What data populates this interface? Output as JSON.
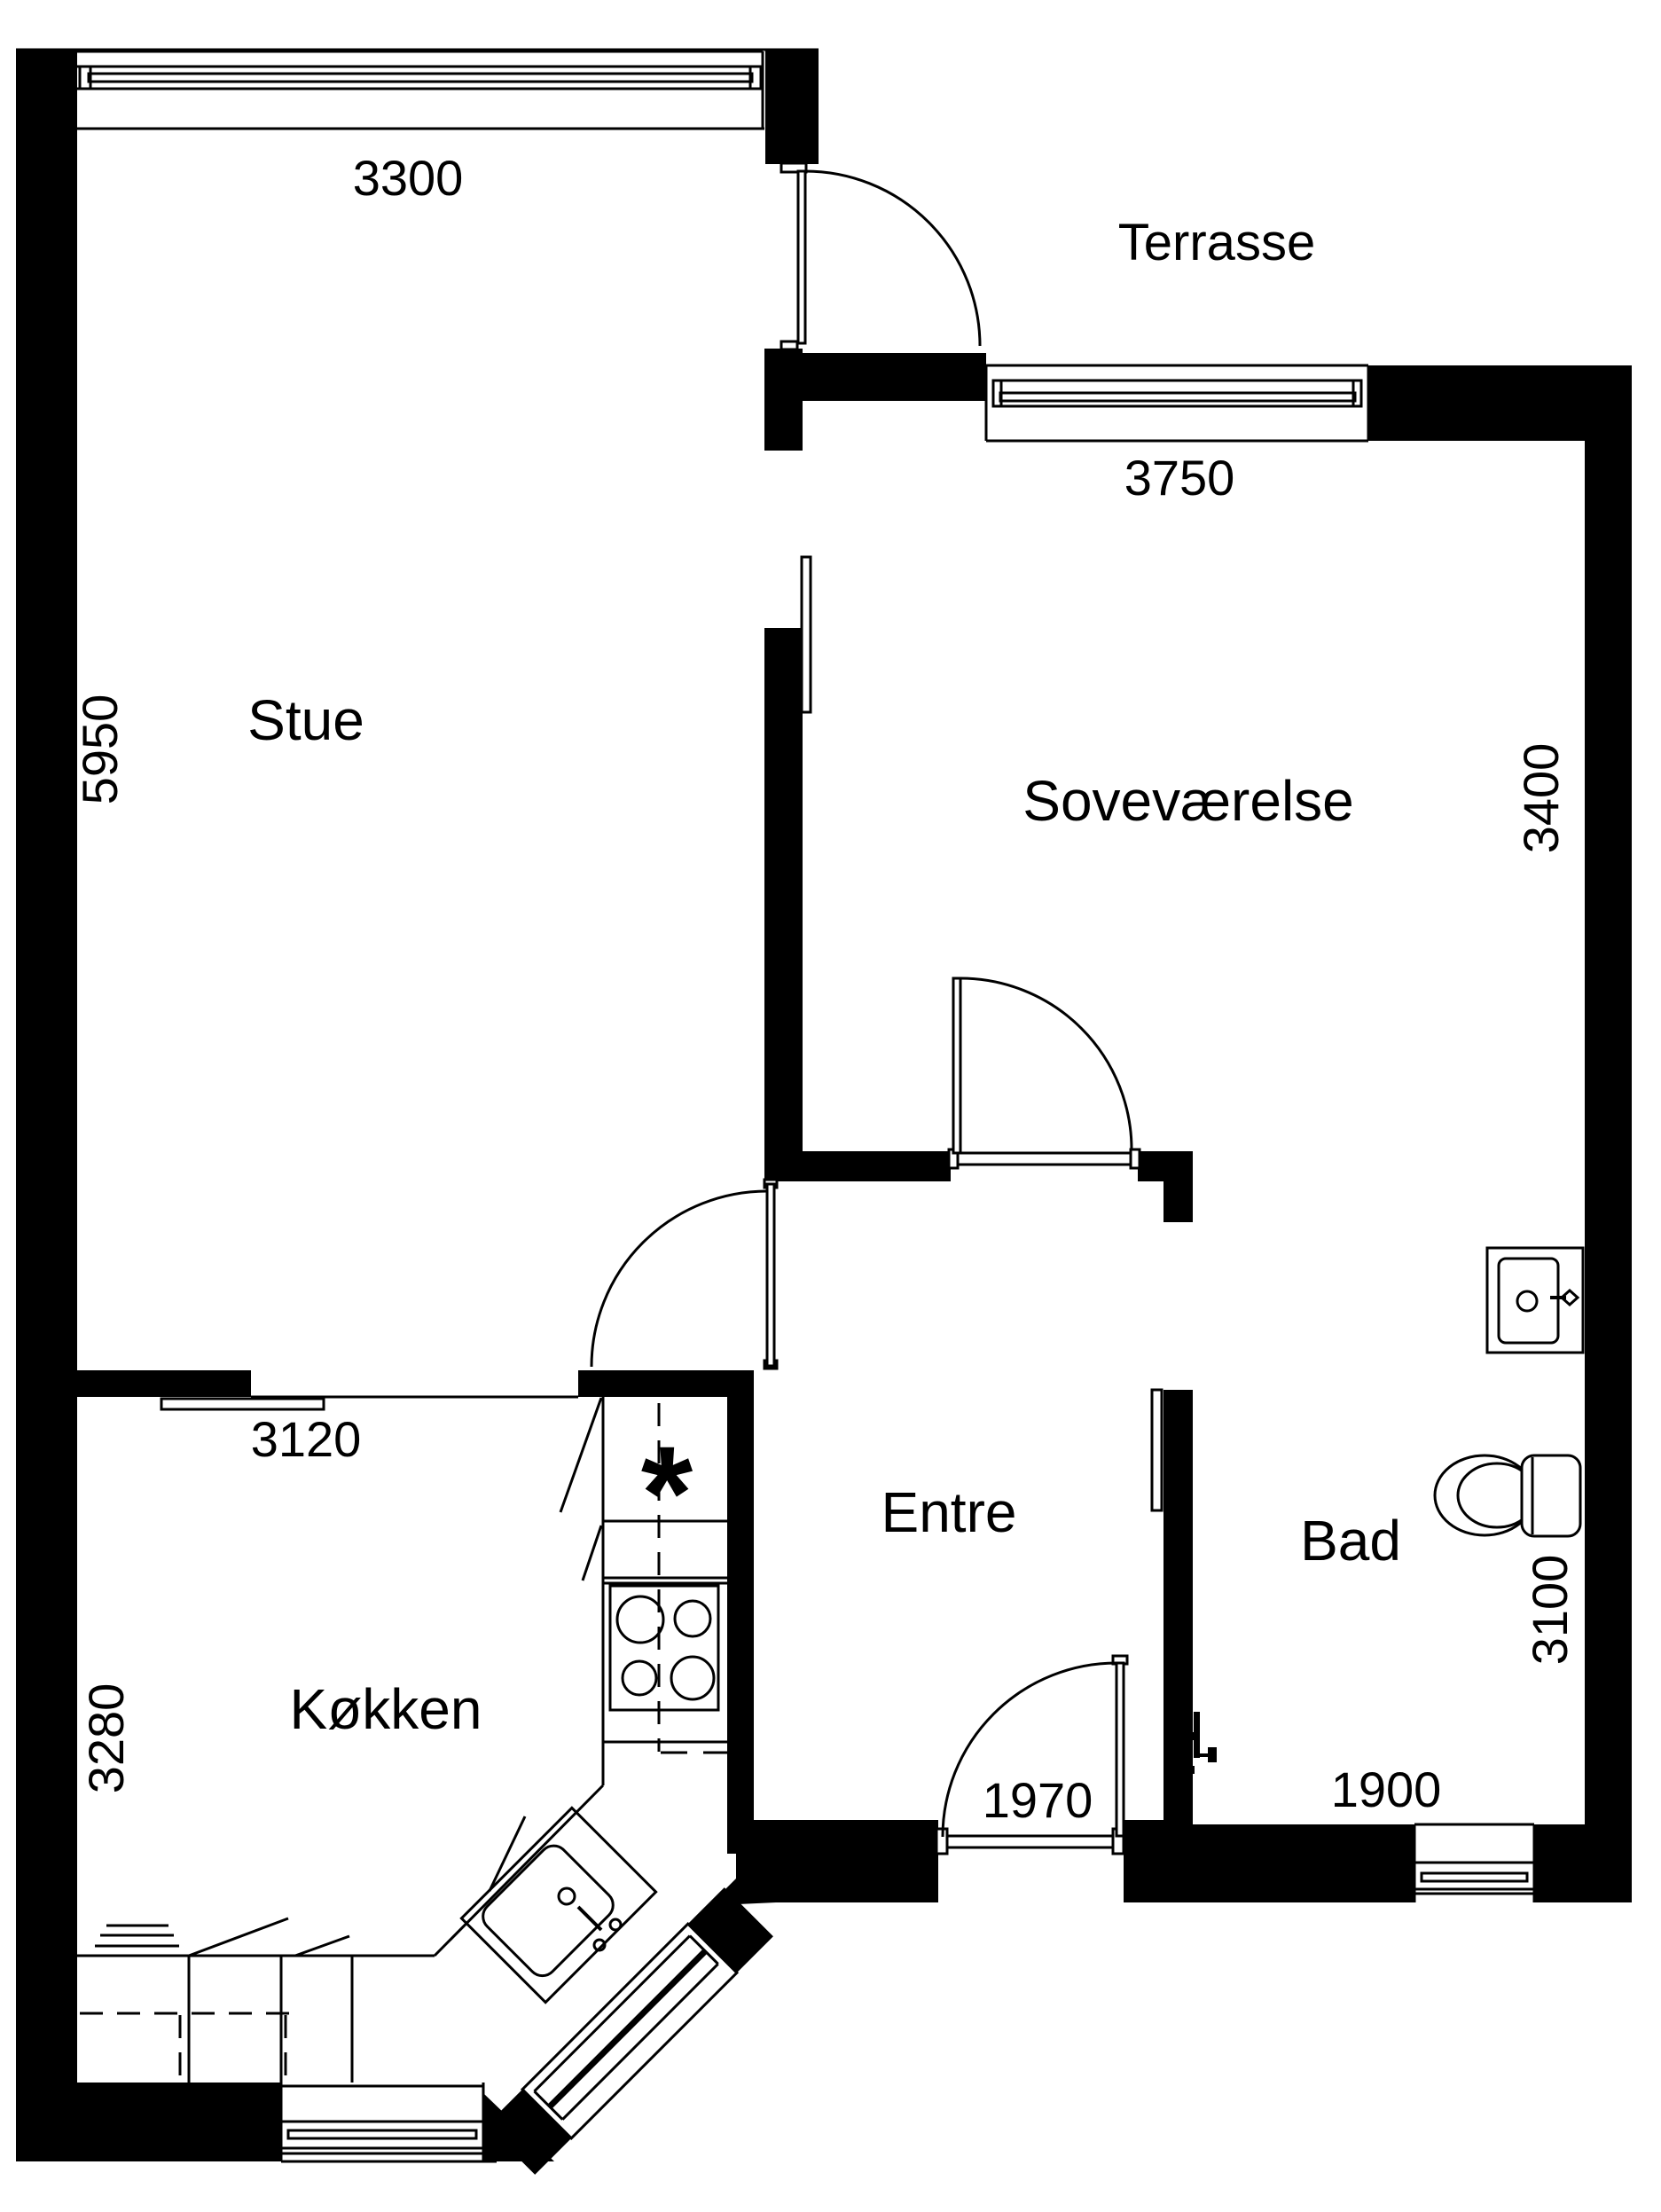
{
  "floorplan": {
    "unit": "mm",
    "colors": {
      "wall": "#000000",
      "background": "#ffffff",
      "line": "#000000"
    },
    "rooms": [
      {
        "name": "Stue",
        "width": "3300",
        "height": "5950"
      },
      {
        "name": "Soveværelse",
        "width": "3750",
        "height": "3400"
      },
      {
        "name": "Køkken",
        "width": "3120",
        "height": "3280"
      },
      {
        "name": "Entre",
        "width": "1970"
      },
      {
        "name": "Bad",
        "width": "1900",
        "height": "3100"
      },
      {
        "name": "Terrasse"
      }
    ],
    "labels": {
      "stue": "Stue",
      "sovevaerelse": "Soveværelse",
      "koekken": "Køkken",
      "entre": "Entre",
      "bad": "Bad",
      "terrasse": "Terrasse"
    },
    "dims": {
      "stue_width": "3300",
      "stue_height": "5950",
      "sove_width": "3750",
      "sove_height": "3400",
      "koekken_width": "3120",
      "koekken_height": "3280",
      "entre_width": "1970",
      "bad_width": "1900",
      "bad_height": "3100"
    },
    "symbols": {
      "appliance_marker": "*"
    }
  }
}
